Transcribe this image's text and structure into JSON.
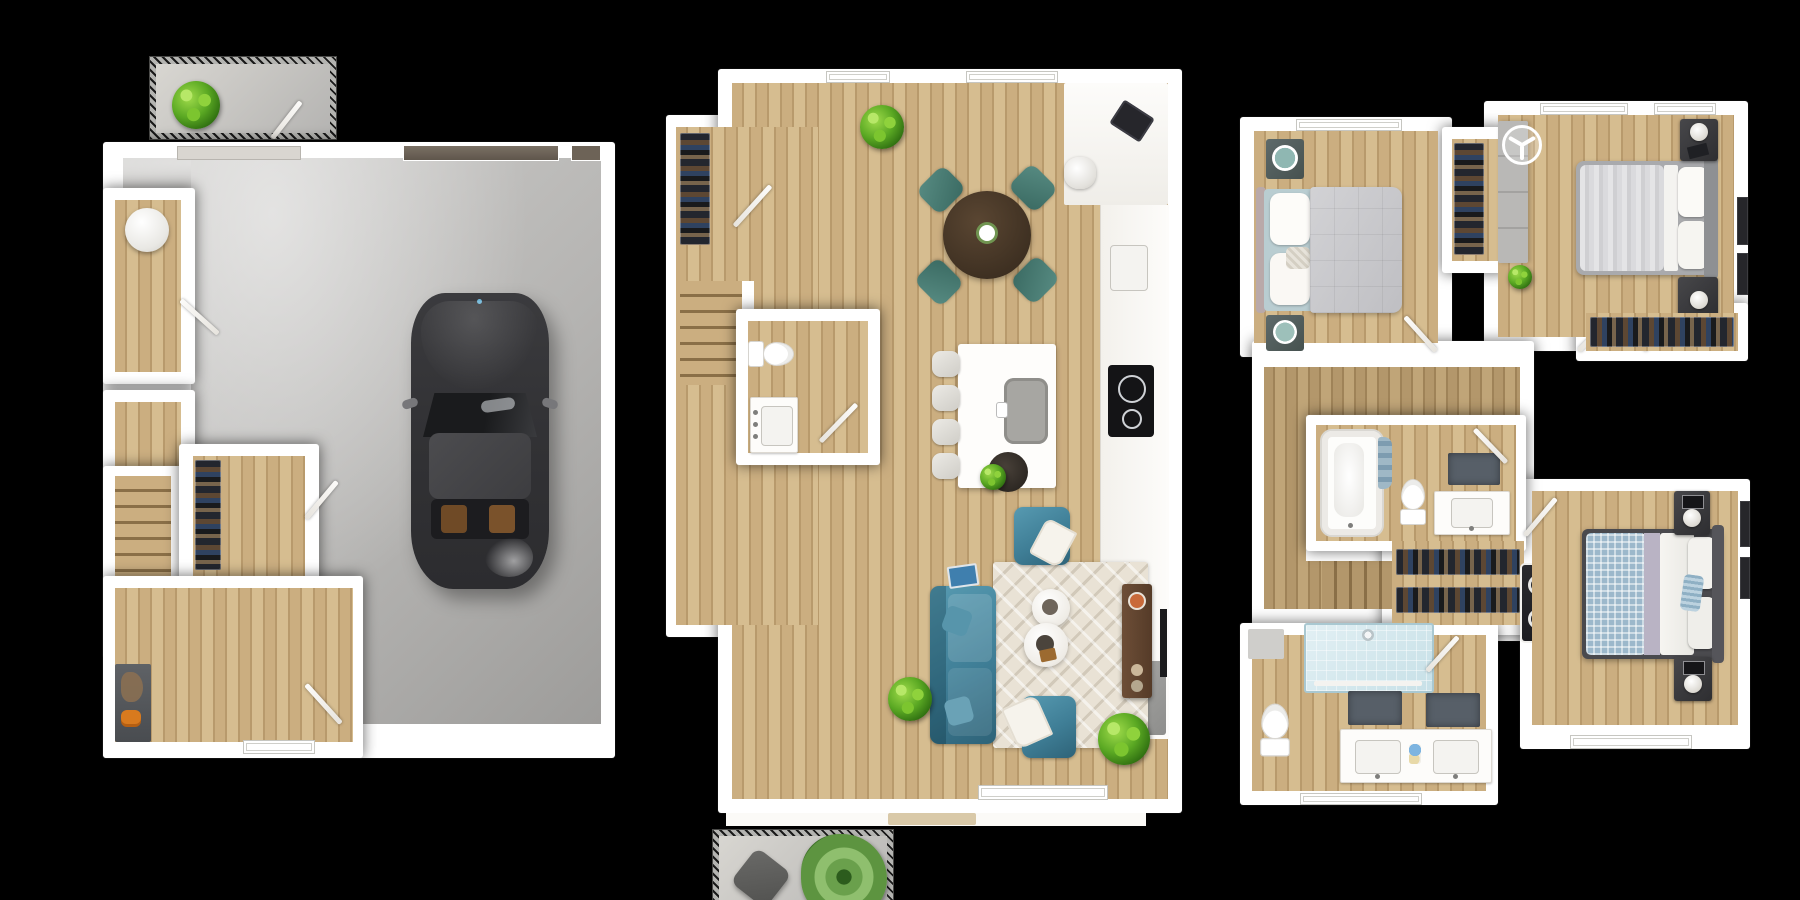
{
  "image": {
    "kind": "3d-floor-plan-set",
    "floor_count": 3,
    "visible_text": "",
    "background": "#000000"
  },
  "palette": {
    "bg": "#000000",
    "wall": "#ffffff",
    "wall-shade": "#e9e7e2",
    "wood": "#cbae80",
    "wood-stripe": "#b89a6c",
    "wood-2": "#d6bd90",
    "wood-dark": "#b3976b",
    "wood-dark-stripe": "#9f8358",
    "wood-dark-2": "#c0a578",
    "stair-line": "#8a6f47",
    "concrete": "#b5b4b2",
    "concrete-hi": "#cecdcb",
    "concrete-lo": "#9d9c9a",
    "concrete-light": "#d8d6d1",
    "teal": "#3f7e96",
    "teal-hi": "#579ab1",
    "teal-lo": "#2e6378",
    "teal-chair": "#47756d",
    "rug": "#e9e2d5",
    "car-body": "#343437",
    "car-roof": "#48484b",
    "glass-shower": "#d6e9ee",
    "mat": "#575f68",
    "appliance-gray": "#9a9a98",
    "console-brown": "#5f4430",
    "duvet-gray": "#c7c7ca",
    "plaid-blue": "#9cb8cb",
    "accent-orange": "#d87a1e",
    "plant-green": "#5aa823"
  },
  "floors": [
    {
      "id": "floor-1",
      "name": "garage-level",
      "rooms": [
        "front-porch",
        "garage",
        "utility-closet",
        "storage-closet",
        "stairwell",
        "under-stair-closet",
        "entry-foyer"
      ],
      "objects": [
        "porch-plant",
        "car",
        "garage-door",
        "water-heater",
        "clothes-rack",
        "coat-console",
        "orange-shoes",
        "entry-door"
      ]
    },
    {
      "id": "floor-2",
      "name": "main-living-level",
      "rooms": [
        "entry-hall",
        "coat-closet",
        "stairwell",
        "powder-room",
        "kitchen",
        "dining-area",
        "living-room",
        "balcony"
      ],
      "objects": [
        "entry-plant",
        "round-dining-table",
        "dining-chairs",
        "kitchen-island",
        "island-sink",
        "bar-stools",
        "produce-bowl",
        "desk-laptop",
        "desk-chair",
        "counter-sink",
        "cooktop",
        "refrigerator",
        "toilet",
        "vanity-sink",
        "sofa",
        "armchairs",
        "throw-blankets",
        "coffee-tables",
        "area-rug",
        "tv-console",
        "wall-tv",
        "floor-plants",
        "balcony-chair",
        "fern-plant"
      ]
    },
    {
      "id": "floor-3",
      "name": "bedroom-level",
      "rooms": [
        "bedroom-2",
        "mid-closet",
        "bedroom-1",
        "walk-in-closet",
        "hallway",
        "stairwell",
        "hall-bathroom",
        "shoe-closet",
        "laundry-niche",
        "primary-bathroom",
        "bedroom-3"
      ],
      "objects": [
        "bed-gray-duvet",
        "teal-tray-nightstands",
        "ceiling-fan",
        "dresser",
        "bed-ruffled-duvet",
        "lamp-nightstands",
        "hanging-clothes",
        "bathtub",
        "blue-towels",
        "toilets",
        "vanity",
        "bath-mats",
        "walk-in-shower",
        "double-vanity",
        "washer-dryer-stack",
        "bed-plaid-blanket",
        "wall-frames",
        "small-plant"
      ]
    }
  ]
}
